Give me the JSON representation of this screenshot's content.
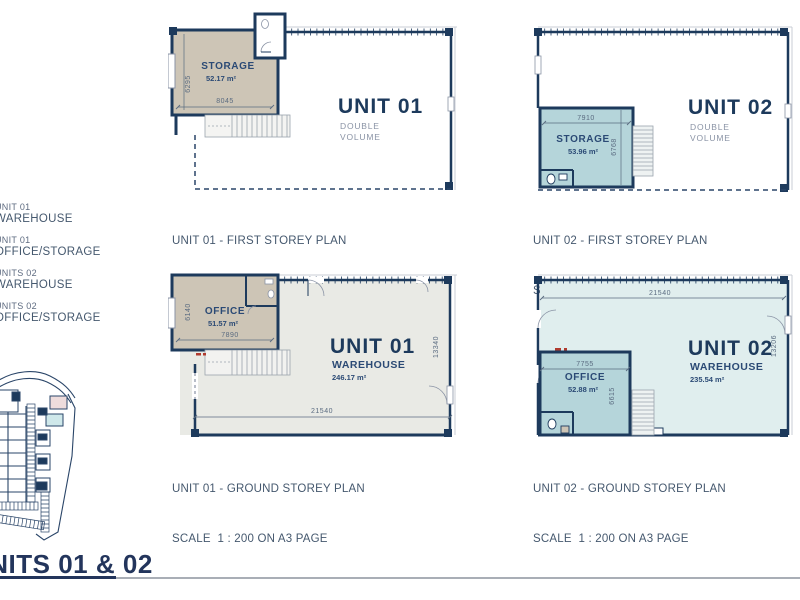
{
  "sheet": {
    "title": "UNITS 01 & 02"
  },
  "legend": {
    "items": [
      {
        "line1": "UNIT 01",
        "line2": "WAREHOUSE"
      },
      {
        "line1": "UNIT 01",
        "line2": "OFFICE/STORAGE"
      },
      {
        "line1": "UNITS 02",
        "line2": "WAREHOUSE"
      },
      {
        "line1": "UNITS 02",
        "line2": "OFFICE/STORAGE"
      }
    ]
  },
  "plans": {
    "u1f": {
      "caption1": "UNIT 01 - FIRST STOREY PLAN",
      "caption2": "SCALE  1 : 200 ON A3 PAGE",
      "unit": "UNIT 01",
      "vol1": "DOUBLE",
      "vol2": "VOLUME",
      "room": "STORAGE",
      "room_area": "52.17 m²",
      "dim_w": "8045",
      "dim_h": "6295"
    },
    "u2f": {
      "caption1": "UNIT 02 - FIRST STOREY PLAN",
      "caption2": "SCALE  1 : 200 ON A3 PAGE",
      "unit": "UNIT 02",
      "vol1": "DOUBLE",
      "vol2": "VOLUME",
      "room": "STORAGE",
      "room_area": "53.96 m²",
      "dim_w": "7910",
      "dim_h": "6768"
    },
    "u1g": {
      "caption1": "UNIT 01 - GROUND STOREY PLAN",
      "caption2": "SCALE  1 : 200 ON A3 PAGE",
      "unit": "UNIT 01",
      "room": "WAREHOUSE",
      "room_area": "246.17 m²",
      "office": "OFFICE",
      "office_area": "51.57 m²",
      "dim_office_w": "7890",
      "dim_office_h": "6140",
      "dim_w": "21540",
      "dim_h": "13340"
    },
    "u2g": {
      "caption1": "UNIT 02 - GROUND STOREY PLAN",
      "caption2": "SCALE  1 : 200 ON A3 PAGE",
      "unit": "UNIT 02",
      "room": "WAREHOUSE",
      "room_area": "235.54 m²",
      "office": "OFFICE",
      "office_area": "52.88 m²",
      "dim_office_w": "7755",
      "dim_office_h": "6615",
      "dim_w": "21540",
      "dim_h": "13206"
    }
  },
  "colors": {
    "navy_wall": "#1d3a5c",
    "slate_text": "#45586e",
    "dim_text": "#5a6b80",
    "muted_label": "#8a93a5",
    "unit01_room_beige": "#cdc5b6",
    "unit02_room_blue": "#b5d5da",
    "unit01_warehouse_gray": "#e9eae5",
    "unit02_warehouse_blue": "#e0eeee",
    "red_marker": "#b03a2e",
    "rule_gray": "#a9aeb6"
  }
}
